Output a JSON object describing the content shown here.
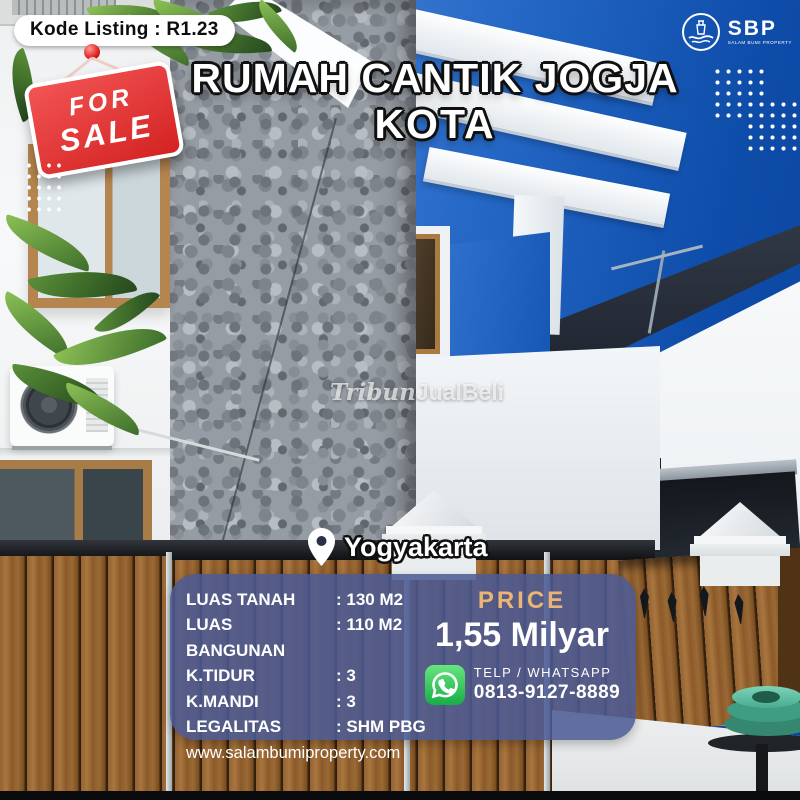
{
  "badge": {
    "text": "Kode Listing : R1.23"
  },
  "sale_sign": {
    "line1": "FOR",
    "line2": "SALE"
  },
  "title": {
    "line1": "RUMAH CANTIK JOGJA",
    "line2": "KOTA"
  },
  "brand": {
    "name": "SBP",
    "tagline": "SALAM BUMI PROPERTY"
  },
  "watermark": {
    "prefix": "Tribun",
    "suffix": "JualBeli"
  },
  "location": {
    "city": "Yogyakarta"
  },
  "details": {
    "rows": [
      {
        "label": "LUAS TANAH",
        "value": ": 130 M2"
      },
      {
        "label": "LUAS BANGUNAN",
        "value": ": 110 M2"
      },
      {
        "label": "K.TIDUR",
        "value": ": 3"
      },
      {
        "label": "K.MANDI",
        "value": ": 3"
      },
      {
        "label": "LEGALITAS",
        "value": ": SHM PBG"
      }
    ],
    "website": "www.salambumiproperty.com"
  },
  "price": {
    "label": "PRICE",
    "value": "1,55 Milyar"
  },
  "contact": {
    "method": "TELP / WHATSAPP",
    "phone": "0813-9127-8889"
  },
  "icons": {
    "location_pin": "map-pin",
    "whatsapp": "whatsapp-logo",
    "brand_emblem": "lighthouse-hands-circle",
    "sale_pin": "red-push-pin"
  },
  "colors": {
    "price_accent": "#ECB473",
    "sale_red": "#D42222",
    "panel_navy": "rgba(76,91,148,0.87)",
    "whatsapp_green": "#25D366",
    "sky_blue": "#0E4CA9",
    "badge_bg": "#FFFFFF"
  }
}
